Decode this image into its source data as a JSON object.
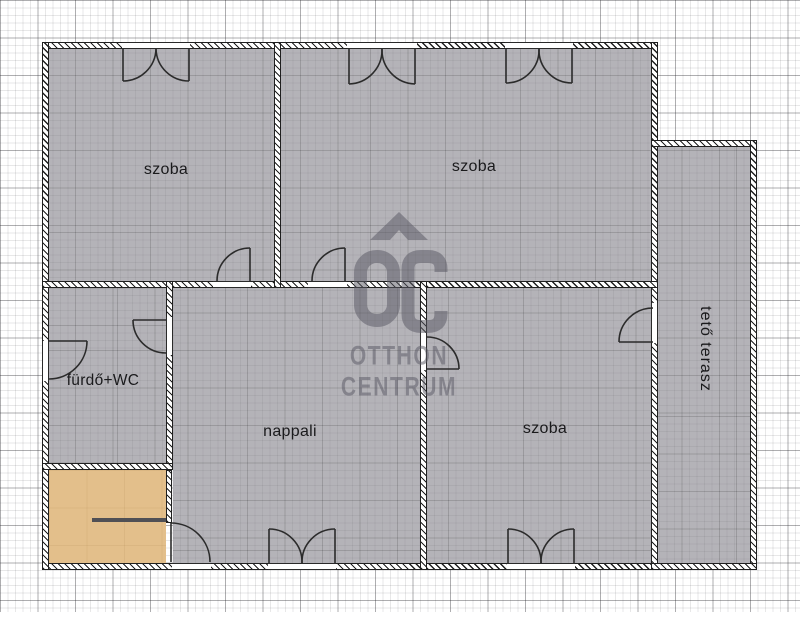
{
  "document": {
    "type": "floor-plan",
    "paper": "grid"
  },
  "rooms": [
    {
      "id": "szoba-top-left",
      "label": "szoba"
    },
    {
      "id": "szoba-top-right",
      "label": "szoba"
    },
    {
      "id": "furdo-wc",
      "label": "fürdő+WC"
    },
    {
      "id": "nappali",
      "label": "nappali"
    },
    {
      "id": "szoba-bottom-right",
      "label": "szoba"
    },
    {
      "id": "teto-terasz",
      "label": "tető terasz"
    }
  ],
  "watermark": {
    "logo": "OC",
    "line1": "OTTHON",
    "line2": "CENTRUM"
  },
  "colors": {
    "room_fill": "#b4b3b8",
    "terrace_entry_accent": "#e3bf8b",
    "wall_line": "#1f1f1f",
    "paper": "#ffffff",
    "watermark_gray": "#5c5b66",
    "label_text": "#1a1a1c",
    "step_line": "#505055"
  }
}
